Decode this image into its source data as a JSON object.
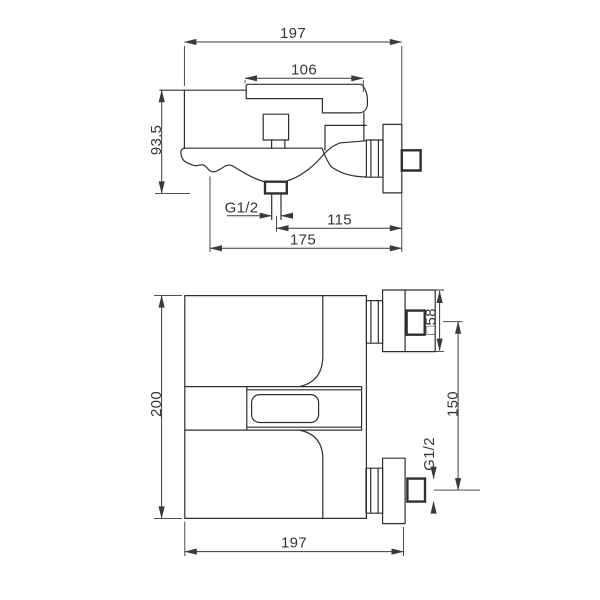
{
  "drawing": {
    "side_view": {
      "overall_depth": "197",
      "handle_length": "106",
      "height": "93.5",
      "outlet_thread": "G1/2",
      "outlet_to_wall": "115",
      "base_depth": "175"
    },
    "plan_view": {
      "overall_height": "200",
      "escutcheon_size": "□58",
      "port_spacing": "150",
      "inlet_thread": "G1/2",
      "overall_width": "197"
    },
    "colors": {
      "line": "#2f2f2f",
      "dimension": "#3a3a3a",
      "background": "#ffffff"
    }
  }
}
